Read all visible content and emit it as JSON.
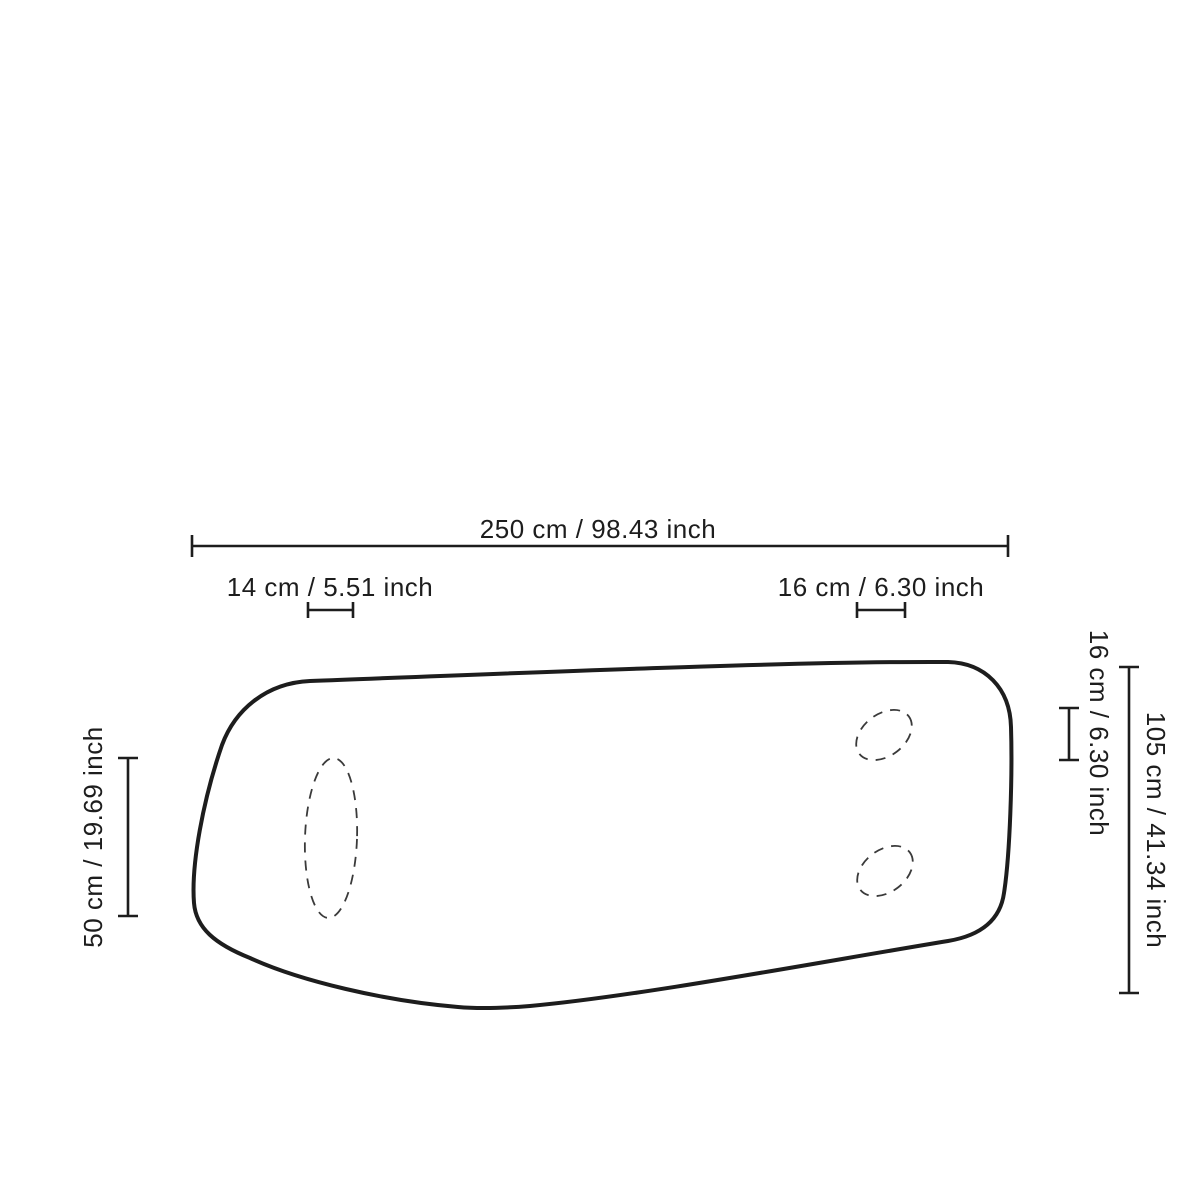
{
  "page": {
    "background_color": "#ffffff",
    "ink_color": "#1d1d1d",
    "description": "Product dimension diagram of an organic rounded panel with three dashed cutouts"
  },
  "diagram": {
    "labels": {
      "total_width": "250 cm / 98.43 inch",
      "left_cutout_width": "14 cm / 5.51 inch",
      "right_cutout_width": "16 cm / 6.30 inch",
      "left_cutout_height": "50 cm / 19.69 inch",
      "right_cutout_height": "16 cm / 6.30 inch",
      "total_height": "105 cm / 41.34 inch"
    },
    "measurements": {
      "total_width_cm": 250,
      "total_width_inch": 98.43,
      "left_cutout_width_cm": 14,
      "left_cutout_width_inch": 5.51,
      "right_cutout_width_cm": 16,
      "right_cutout_width_inch": 6.3,
      "left_cutout_height_cm": 50,
      "left_cutout_height_inch": 19.69,
      "right_cutout_height_cm": 16,
      "right_cutout_height_inch": 6.3,
      "total_height_cm": 105,
      "total_height_inch": 41.34
    }
  }
}
